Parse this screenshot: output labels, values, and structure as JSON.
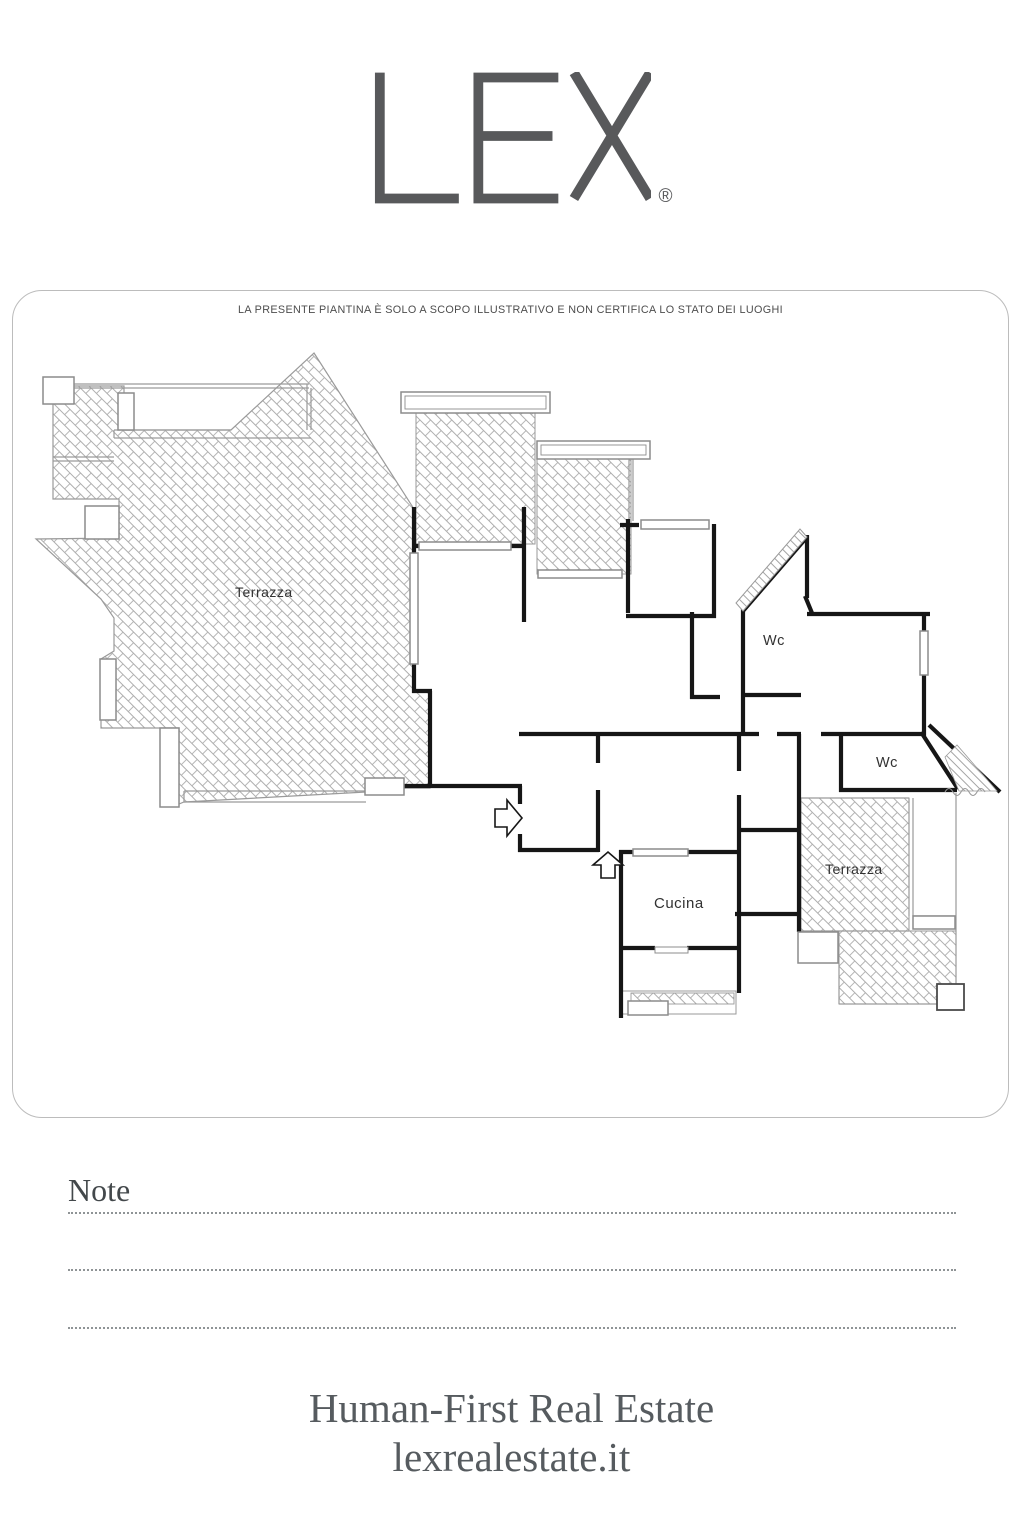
{
  "brand": {
    "logo_text": "LEX",
    "reg_mark": "®"
  },
  "plan": {
    "disclaimer": "LA PRESENTE PIANTINA È SOLO A SCOPO ILLUSTRATIVO E NON CERTIFICA LO STATO DEI LUOGHI",
    "labels": {
      "terrace_left": "Terrazza",
      "wc_top": "Wc",
      "wc_right": "Wc",
      "terrace_right": "Terrazza",
      "kitchen": "Cucina"
    }
  },
  "notes": {
    "title": "Note"
  },
  "footer": {
    "tagline": "Human-First Real Estate",
    "website": "lexrealestate.it"
  },
  "colors": {
    "wall": "#161616",
    "thin_line": "#9a9a9a",
    "hatch": "#aeaeae",
    "logo": "#58595b",
    "frame_border": "#bcbcbc",
    "label_text": "#323232"
  }
}
